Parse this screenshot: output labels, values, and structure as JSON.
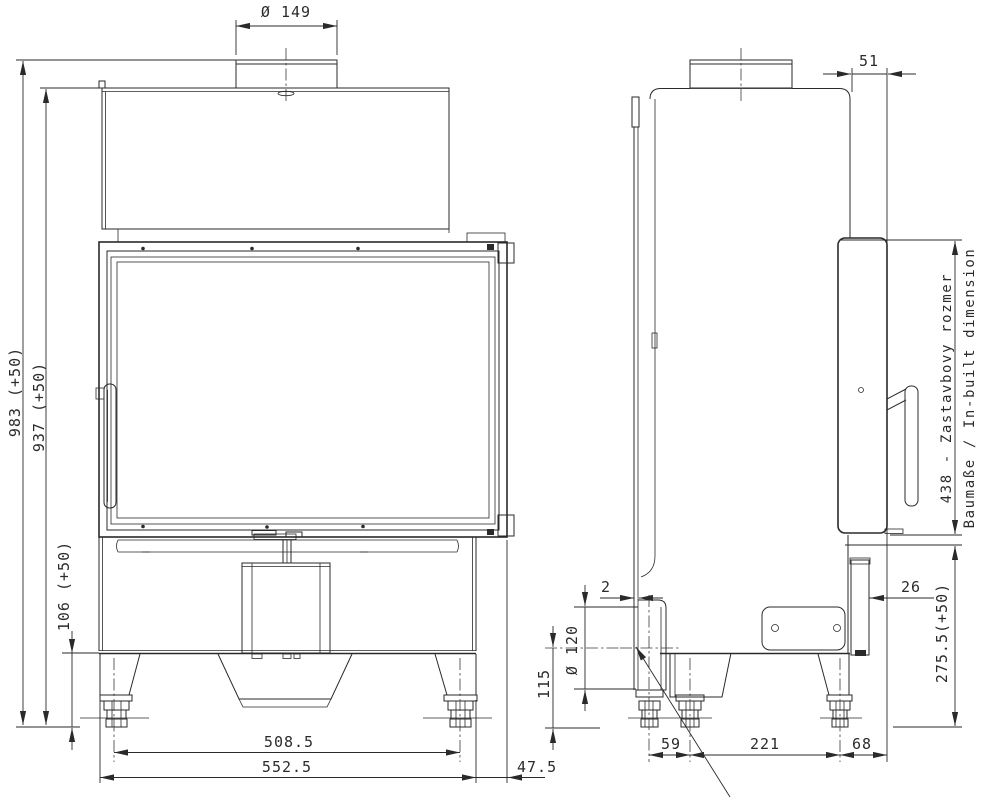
{
  "drawing": {
    "kind": "technical dimension drawing",
    "subject": "fireplace insert / stove, front and side orthographic views",
    "units": "mm",
    "line_color": "#2a2a2a",
    "background": "#ffffff"
  },
  "views": {
    "front": {
      "name": "front-view",
      "dimensions": {
        "flue_diameter": "Ø 149",
        "overall_height": "983 (+50)",
        "body_height": "937 (+50)",
        "plinth_height": "106 (+50)",
        "feet_spacing": "508.5",
        "overall_width": "552.5",
        "frame_side_overhang": "47.5"
      }
    },
    "side": {
      "name": "side-view",
      "dimensions": {
        "door_frame_depth": "51",
        "inbuilt_height": "438 - Zastavbovy rozmer",
        "inbuilt_height_translation": "Baumaße / In-built dimension",
        "lower_front_height": "275.5(+50)",
        "lower_panel_setback": "26",
        "rear_shield_gap": "2",
        "air_intake_diameter": "Ø 120",
        "air_intake_center_height": "115",
        "rear_feet_gap": "59",
        "feet_spacing": "221",
        "front_foot_setback": "68"
      }
    }
  }
}
